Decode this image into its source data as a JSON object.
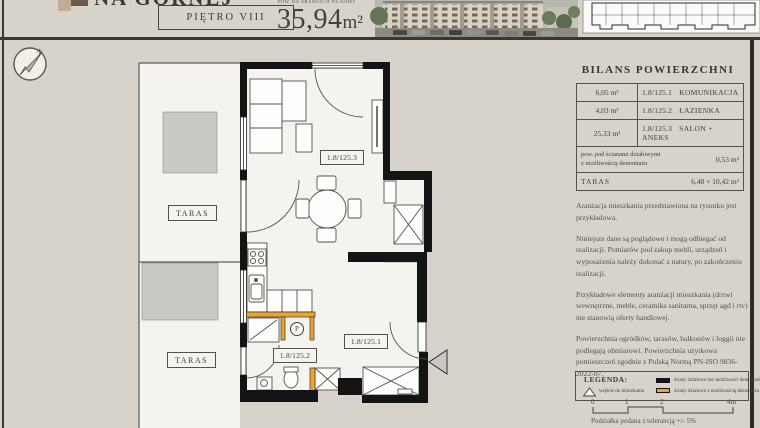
{
  "header": {
    "logo_text": "NA GÓRNEJ",
    "floor_label": "PIĘTRO VIII",
    "area_caption": "POW. DO ARANŻACJI WŁASNEJ",
    "area_value": "35,94",
    "area_unit": "m²"
  },
  "north": {
    "label": "N"
  },
  "plan": {
    "taras_upper": "TARAS",
    "taras_lower": "TARAS",
    "code_salon": "1.8/125.3",
    "code_bath": "1.8/125.2",
    "code_hall": "1.8/125.1",
    "washer": "P"
  },
  "balance": {
    "title": "BILANS POWIERZCHNI",
    "rows": [
      {
        "area": "6,05 m²",
        "code": "1.8/125.1",
        "name": "KOMUNIKACJA"
      },
      {
        "area": "4,03 m²",
        "code": "1.8/125.2",
        "name": "ŁAZIENKA"
      },
      {
        "area": "25,33 m²",
        "code": "1.8/125.3",
        "name": "SALON + ANEKS"
      }
    ],
    "partition": {
      "line1": "pow. pod ścianami działowymi",
      "line2": "z możliwością demontażu",
      "value": "0,53 m²"
    },
    "taras": {
      "label": "TARAS",
      "value": "6,48 + 10,42 m²"
    }
  },
  "notes": [
    "Aranżacja mieszkania przedstawiona na rysunku jest przykładowa.",
    "Niniejsze dane są poglądowe i mogą odbiegać od realizacji. Pomiarów pod zakup mebli, urządzeń i wyposażenia należy dokonać z natury, po zakończeniu realizacji.",
    "Przykładowe elementy aranżacji mieszkania (drzwi wewnętrzne, meble, ceramika sanitarna, sprzęt agd i rtv) nie stanowią oferty handlowej.",
    "Powierzchnia ogródków, tarasów, balkonów i loggii nie podlegają obmiarowi. Powierzchnia użytkowa pomieszczeń zgodnie z Polską Normą PN-ISO 9836-2022-07."
  ],
  "legend": {
    "title": "LEGENDA:",
    "entrance": "wejście do mieszkania",
    "wall_fixed": "ściany działowe bez możliwości demontażu",
    "wall_removable": "ściany działowe z możliwością demontażu",
    "scale": [
      "0",
      "1",
      "2",
      "4m"
    ],
    "tolerance": "Podziałka podana z tolerancją +/- 5%"
  },
  "colors": {
    "background": "#d7d3ca",
    "wall_black": "#141414",
    "wall_removable_orange": "#efa32f",
    "terrace_gray": "#c9c9c5",
    "dark_rule": "#3b372f"
  }
}
